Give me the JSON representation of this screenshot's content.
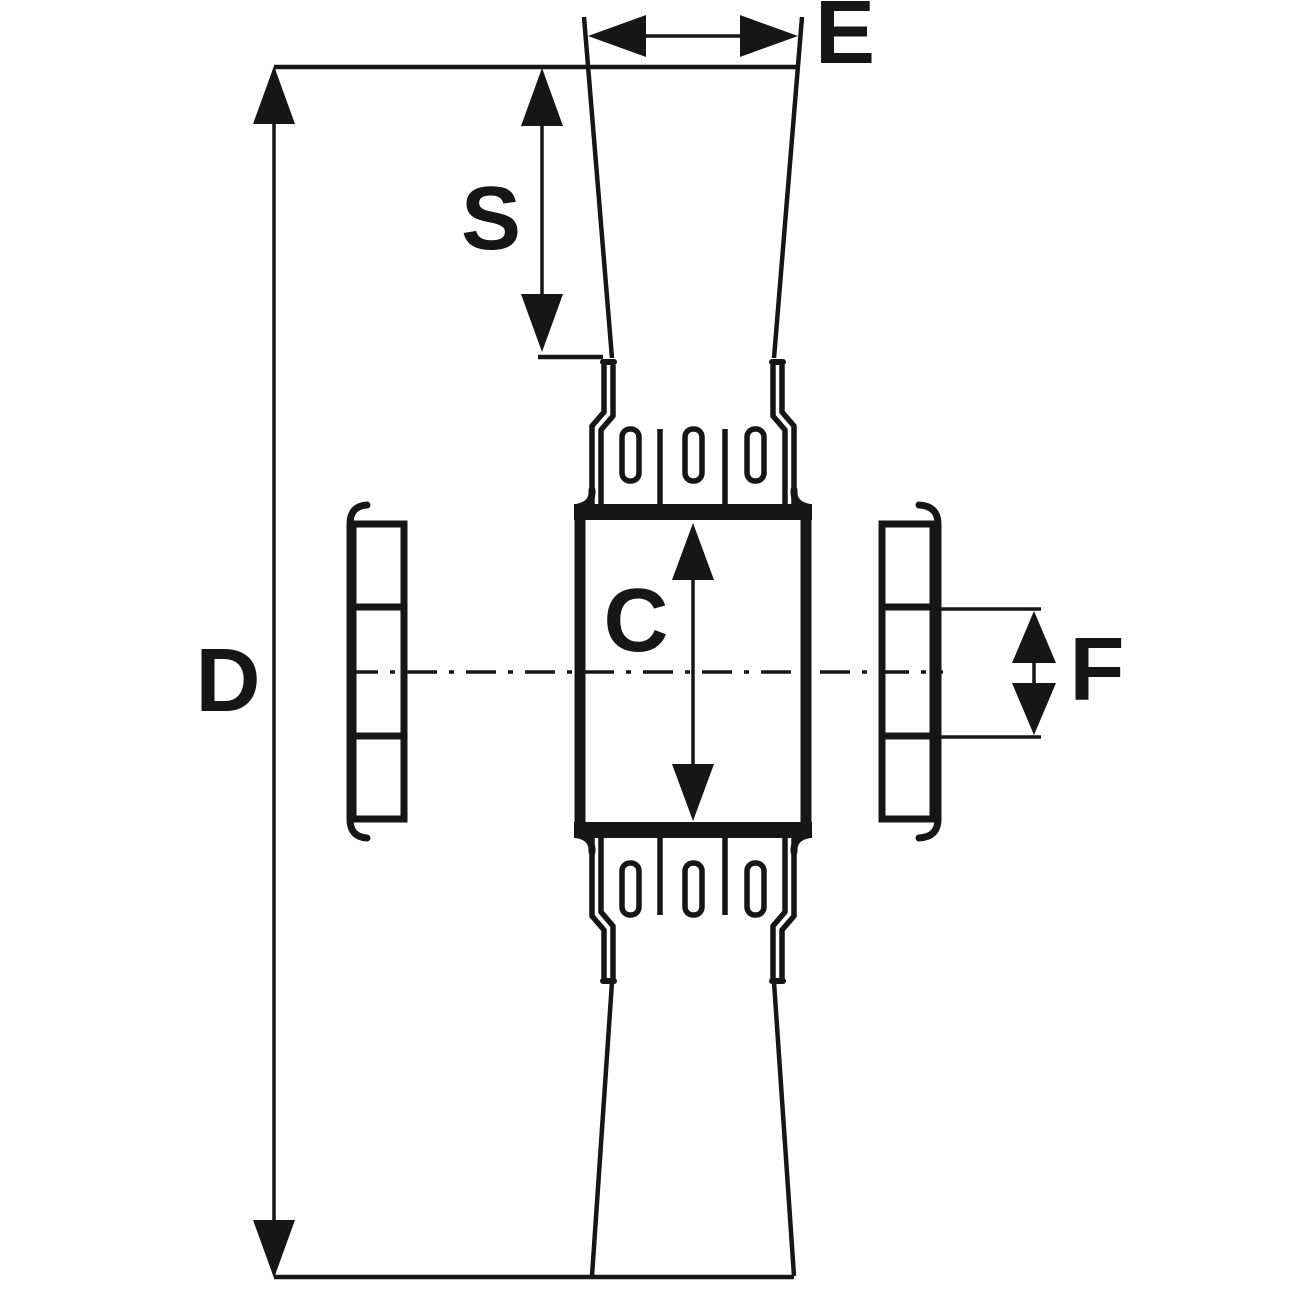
{
  "labels": {
    "d": "D",
    "e": "E",
    "s": "S",
    "c": "C",
    "f": "F"
  },
  "colors": {
    "line": "#161616",
    "background": "#ffffff"
  }
}
